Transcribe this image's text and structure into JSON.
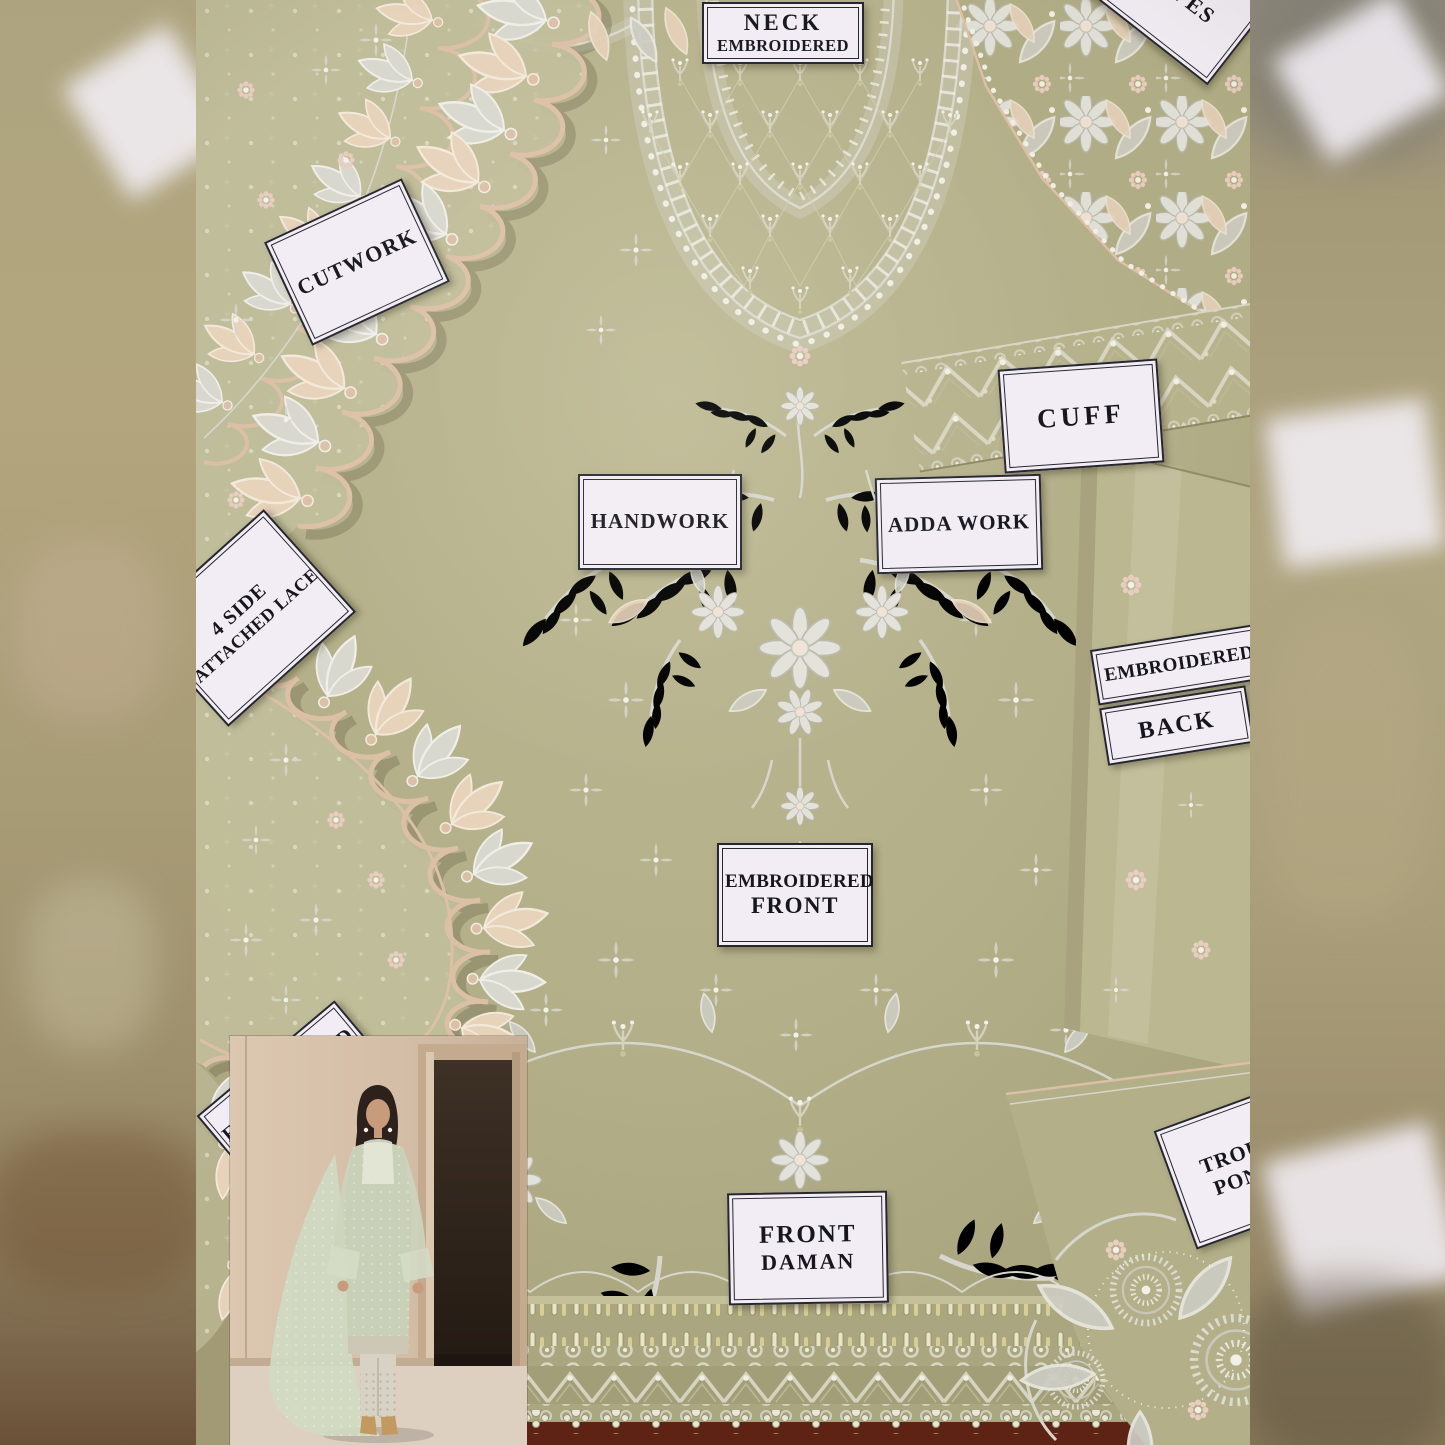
{
  "labels": {
    "neck": {
      "line1": "NECK",
      "line2": "EMBROIDERED"
    },
    "sleeves": {
      "line1": "SLEEVES"
    },
    "cutwork": {
      "line1": "CUTWORK"
    },
    "cuff": {
      "line1": "CUFF"
    },
    "handwork": {
      "line1": "HANDWORK"
    },
    "adda_work": {
      "line1": "ADDA WORK"
    },
    "attached_lace": {
      "line1": "4 SIDE",
      "line2": "ATTACHED LACE"
    },
    "embroidered_back": {
      "line1": "EMBROIDERED",
      "line2": "BACK"
    },
    "embroidered_front": {
      "line1": "EMBROIDERED",
      "line2": "FRONT"
    },
    "front_daman": {
      "line1": "FRONT",
      "line2": "DAMAN"
    },
    "trouser_poncha": {
      "line1": "TROUSER",
      "line2": "PONCHA"
    },
    "hidden_embroidered": {
      "line1": "EMBROIDERED"
    }
  },
  "colors": {
    "fabric_sage": "#b5b18b",
    "fabric_light": "#c6c29e",
    "fabric_dark": "#a19d78",
    "embroidery_silver": "#d7d6cc",
    "sparkle": "#f2f1e8",
    "champagne": "#dcc0a6",
    "champagne_l": "#e7d2ba",
    "blush": "#e9cdc0",
    "label_bg": "#f2ecf4",
    "label_border": "#26262f",
    "label_text": "#16161e",
    "maroon": "#5f2316",
    "band_tan": "#a89e7c",
    "inset_wall": "#d3bda7",
    "inset_floor": "#ddd0c0",
    "door_dark": "#32271e",
    "hair": "#2c211b",
    "skin": "#c79b7c",
    "dress_mint": "#c8d1b7",
    "dupatta_mint": "#d0dac2",
    "trouser_ivory": "#d8d2c5",
    "heel_tan": "#c2995f"
  }
}
